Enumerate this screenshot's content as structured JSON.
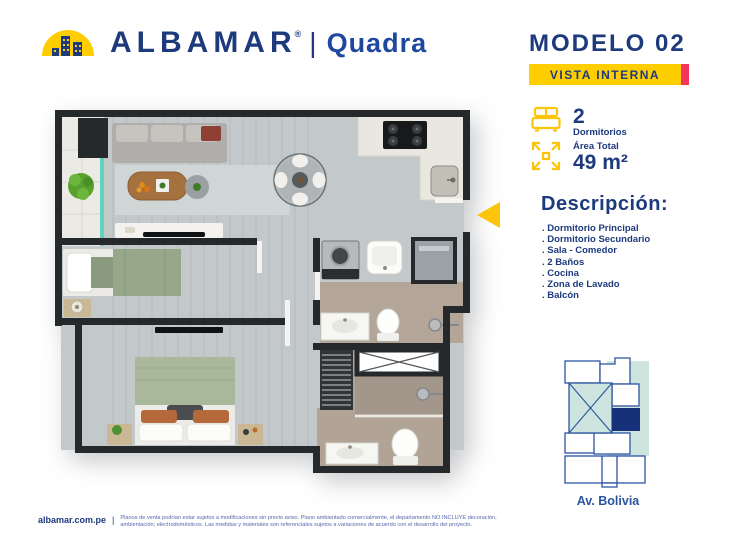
{
  "header": {
    "brand": "ALBAMAR",
    "registered_mark": "®",
    "divider": "|",
    "sub_brand": "Quadra",
    "model_title": "MODELO 02",
    "view_badge": "VISTA INTERNA"
  },
  "specs": {
    "bedrooms_value": "2",
    "bedrooms_label": "Dormitorios",
    "area_label": "Área Total",
    "area_value": "49 m²"
  },
  "description": {
    "heading": "Descripción:",
    "items": [
      ". Dormitorio Principal",
      ". Dormitorio Secundario",
      ". Sala - Comedor",
      ". 2 Baños",
      ". Cocina",
      ". Zona de Lavado",
      ". Balcón"
    ]
  },
  "location_map": {
    "street_label": "Av. Bolivia"
  },
  "footer": {
    "website": "albamar.com.pe",
    "divider": "|",
    "disclaimer_line1": "Planos de venta podrían estar sujetos a modificaciones sin previo aviso. Plano ambientado comercialmente, el departamento NO INCLUYE decoración,",
    "disclaimer_line2": "ambientación; electrodomésticos. Las medidas y materiales son referenciales sujetos a variaciones de acuerdo con el desarrollo del proyecto."
  },
  "icons": {
    "logo": "dome-buildings-icon",
    "bedrooms": "bed-icon",
    "area": "expand-arrows-icon",
    "entrance": "triangle-arrow-left-icon"
  },
  "colors": {
    "brand_navy": "#1D3A7C",
    "accent_yellow": "#FFCE00",
    "badge_pink": "#F4365C",
    "map_blue": "#2B55A0",
    "map_highlight_navy": "#17307A",
    "map_teal": "#CDE4DF",
    "glass_teal": "#5FD3BD"
  }
}
